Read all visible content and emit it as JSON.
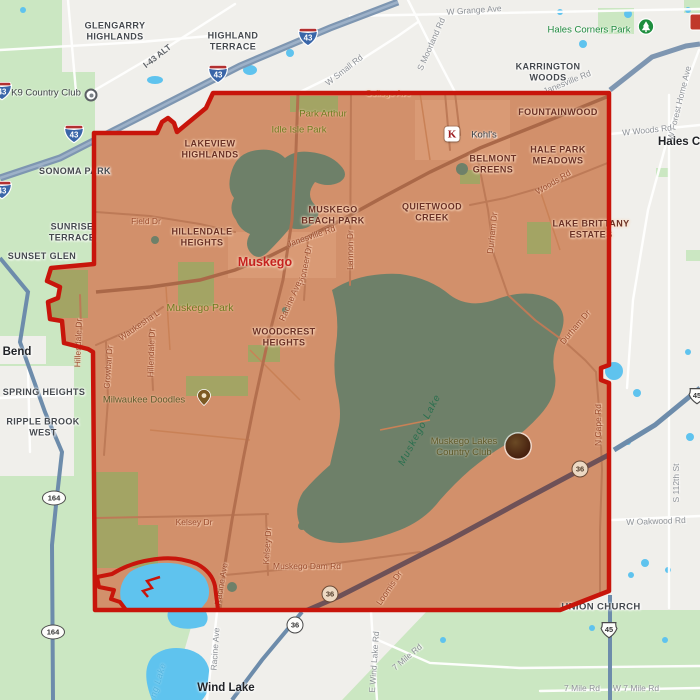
{
  "map_type": "city-boundary-map",
  "city_label": "Muskego",
  "towns": {
    "bend": "Bend",
    "wind_lake": "Wind Lake",
    "hales_corners_partial": "Hales C",
    "union_church": "UNION CHURCH"
  },
  "neighborhoods_outside": {
    "glengarry_highlands": "GLENGARRY HIGHLANDS",
    "highland_terrace": "HIGHLAND TERRACE",
    "karrington_woods": "KARRINGTON WOODS",
    "sonoma_park": "SONOMA PARK",
    "sunrise_terrace": "SUNRISE TERRACE",
    "sunset_glen": "SUNSET GLEN",
    "spring_heights": "SPRING HEIGHTS",
    "ripple_brook_west": "RIPPLE BROOK WEST"
  },
  "neighborhoods_inside": {
    "lakeview_highlands": "LAKEVIEW HIGHLANDS",
    "fountainwood": "FOUNTAINWOOD",
    "belmont_greens": "BELMONT GREENS",
    "hale_park_meadows": "HALE PARK MEADOWS",
    "quietwood_creek": "QUIETWOOD CREEK",
    "muskego_beach_park": "MUSKEGO BEACH PARK",
    "hillendale_heights": "HILLENDALE HEIGHTS",
    "lake_brittany_estates": "LAKE BRITTANY ESTATES",
    "woodcrest_heights": "WOODCREST HEIGHTS"
  },
  "parks": {
    "hales_corners_park": "Hales Corners Park",
    "park_arthur": "Park Arthur",
    "idle_isle_park": "Idle Isle Park",
    "muskego_park": "Muskego Park"
  },
  "pois": {
    "k9_country_club": "K9 Country Club",
    "kohls": "Kohl's",
    "kohls_initial": "K",
    "milwaukee_doodles": "Milwaukee Doodles",
    "muskego_lakes_country_club": "Muskego Lakes Country Club"
  },
  "water": {
    "muskego_lake": "Muskego Lake",
    "small_lake_partial": "ng Lake"
  },
  "roads": {
    "w_grange_ave": "W Grange Ave",
    "s_moorland_rd": "S Moorland Rd",
    "w_small_rd": "W Small Rd",
    "janesville_rd": "Janesville Rd",
    "w_forest_home_ave": "W Forest Home Ave",
    "w_woods_rd": "W Woods Rd",
    "s_112th_st": "S 112th St",
    "w_oakwood_rd": "W Oakwood Rd",
    "n_cape_rd": "N Cape Rd",
    "seven_mile_rd": "7 Mile Rd",
    "w_seven_mile_rd": "W 7 Mile Rd",
    "e_wind_lake_rd": "E Wind Lake Rd",
    "racine_ave": "Racine Ave",
    "college_ave": "College Ave",
    "field_dr": "Field Dr",
    "lannon_dr": "Lannon Dr",
    "pioneer_dr": "Pioneer Dr",
    "waukesha_ln": "Waukesha L",
    "hillendale_dr": "Hillendale Dr",
    "crowbar_dr": "Crowbar Dr",
    "durham_dr": "Durham Dr",
    "woods_rd": "Woods Rd",
    "kelsey_dr": "Kelsey Dr",
    "muskego_dam_rd": "Muskego Dam Rd",
    "loomis_dr": "Loomis Dr"
  },
  "shields": {
    "interstate_43": "43",
    "i43_alt": "I-43 ALT",
    "route_164": "164",
    "route_36": "36",
    "route_45": "45"
  },
  "colors": {
    "boundary_red": "#c8150b",
    "city_fill": "#d2906b",
    "outside_green": "#cbe7c2",
    "water_outside": "#5fc3ee",
    "water_inside": "#6e8069",
    "freeway_blue": "#7e96b1"
  }
}
